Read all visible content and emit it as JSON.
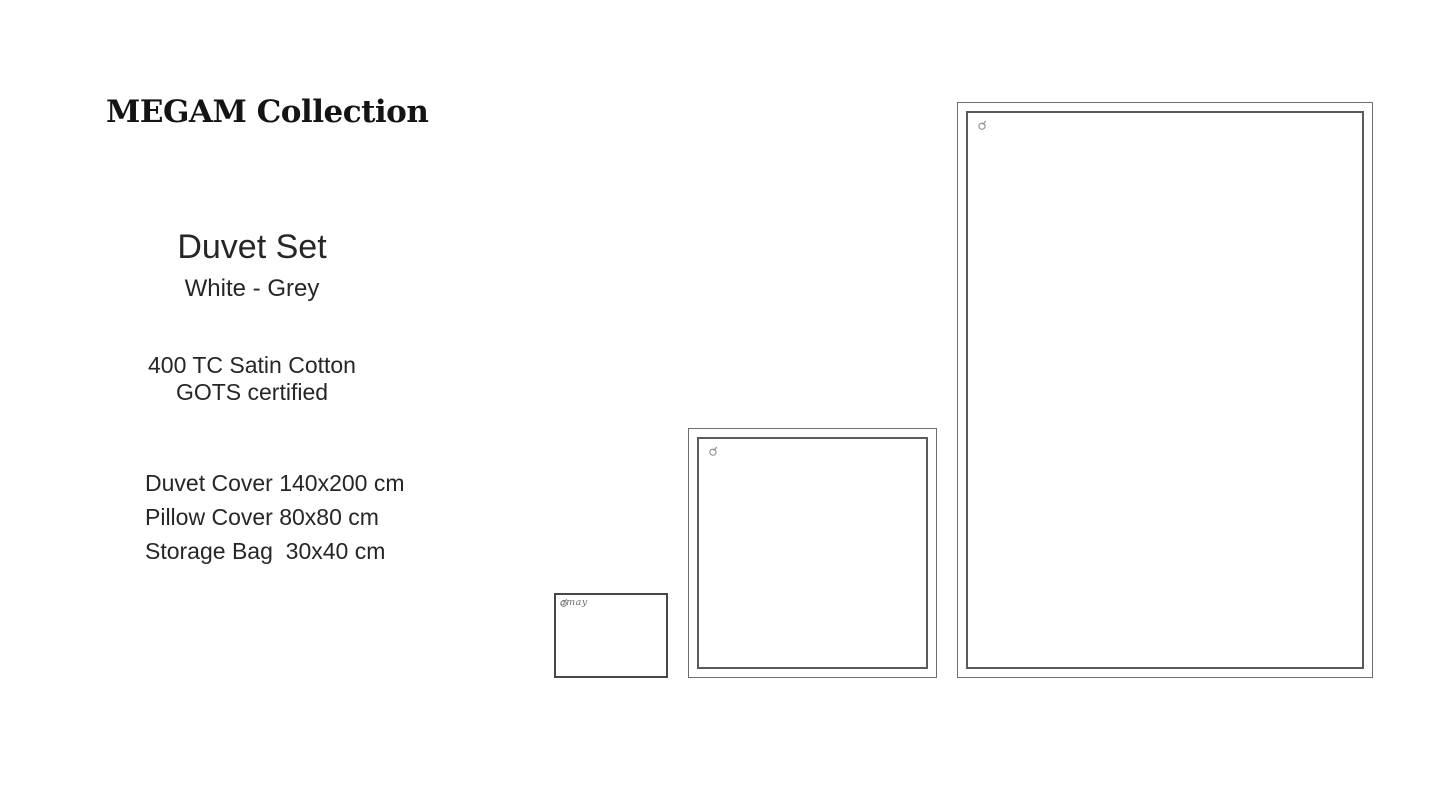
{
  "page": {
    "background": "#ffffff",
    "text_color": "#262626",
    "outline_color": "#5a5a5a"
  },
  "header": {
    "title": "MEGAM Collection"
  },
  "product": {
    "name": "Duvet Set",
    "colorway": "White - Grey",
    "material_line1": "400 TC Satin Cotton",
    "material_line2": "GOTS certified",
    "sizes": [
      "Duvet Cover 140x200 cm",
      "Pillow Cover 80x80 cm",
      "Storage Bag  30x40 cm"
    ]
  },
  "swatches": {
    "duvet_cover": {
      "item": "Duvet Cover outline"
    },
    "pillow_cover": {
      "item": "Pillow Cover outline"
    },
    "storage_bag": {
      "item": "Storage Bag outline",
      "logo_text": "amay"
    },
    "brand_mark_icon": "circle-slash brand mark"
  }
}
